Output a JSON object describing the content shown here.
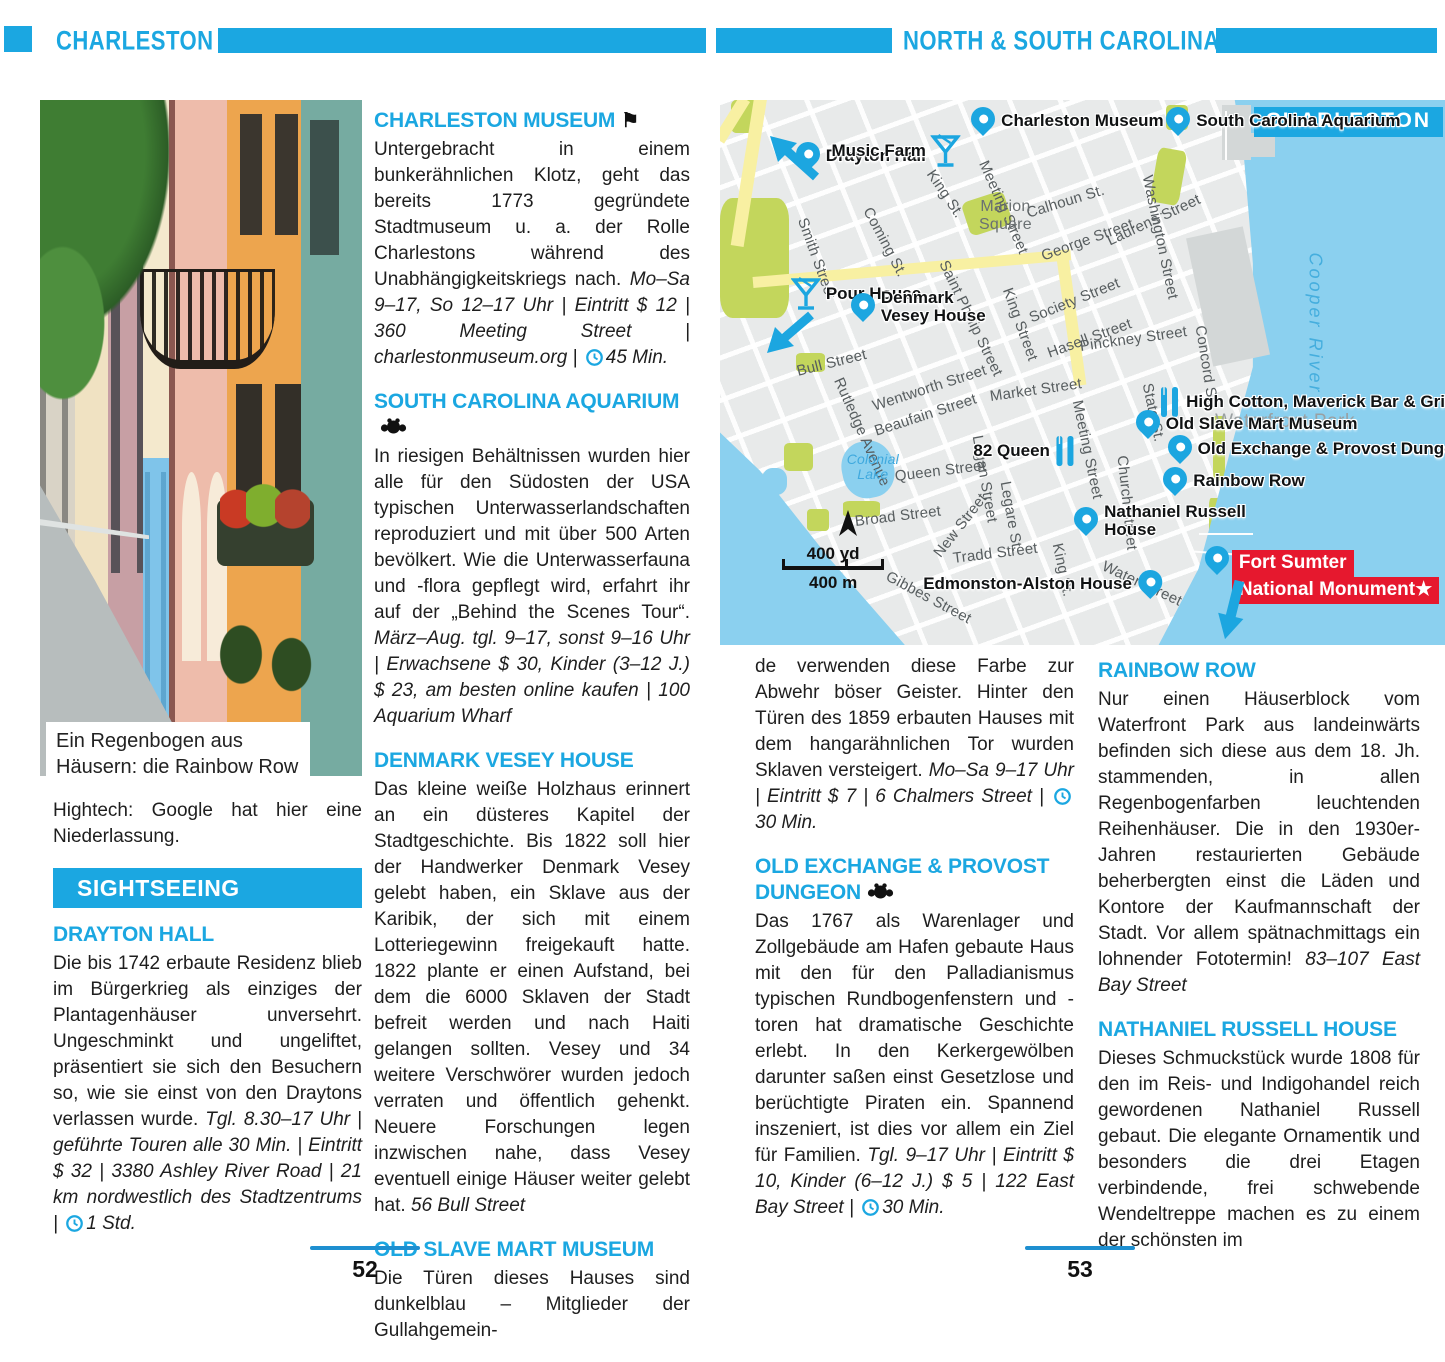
{
  "colors": {
    "accent": "#1ba7e1",
    "map_water": "#8bd0ef",
    "map_park": "#c3d65c",
    "map_road": "#f8f0a2",
    "fort_red": "#e6182e"
  },
  "header": {
    "left_title": "CHARLESTON",
    "right_title": "NORTH & SOUTH CAROLINA"
  },
  "icons": {
    "flag_glyph": "⚑",
    "star_glyph": "★"
  },
  "left_page": {
    "photo_caption": "Ein Regenbogen aus Häusern: die Rainbow Row",
    "intro_paragraph": "Hightech: Google hat hier eine Niederlassung.",
    "section_banner": "SIGHTSEEING",
    "page_number": "52"
  },
  "right_page": {
    "page_number": "53"
  },
  "articles": {
    "drayton_hall": {
      "heading": "DRAYTON HALL",
      "body": "Die bis 1742 erbaute Residenz blieb im Bürgerkrieg als einziges der Plantagenhäuser unversehrt. Ungeschminkt und ungeliftet, präsentiert sie sich den Besuchern so, wie sie einst von den Draytons verlassen wurde.",
      "info": "Tgl. 8.30–17 Uhr | geführte Touren alle 30 Min. | Eintritt $ 32 | 3380 Ashley River Road | 21 km nordwestlich des Stadtzentrums |",
      "duration": "1 Std."
    },
    "charleston_museum": {
      "heading": "CHARLESTON MUSEUM",
      "body": "Untergebracht in einem bunkerähnlichen Klotz, geht das bereits 1773 gegründete Stadtmuseum u. a. der Rolle Charlestons während des Unabhängigkeitskriegs nach.",
      "info": "Mo–Sa 9–17, So 12–17 Uhr | Eintritt $ 12 | 360 Meeting Street | charlestonmuseum.org |",
      "duration": "45 Min."
    },
    "south_carolina_aquarium": {
      "heading": "SOUTH CAROLINA AQUARIUM",
      "body": "In riesigen Behältnissen wurden hier alle für den Südosten der USA typischen Unterwasserlandschaften reproduziert und mit über 500 Arten bevölkert. Wie die Unterwasserfauna und -flora gepflegt wird, erfahrt ihr auf der „Behind the Scenes Tour“.",
      "info": "März–Aug. tgl. 9–17, sonst 9–16 Uhr | Erwachsene $ 30, Kinder (3–12 J.) $ 23, am besten online kaufen | 100 Aquarium Wharf",
      "duration": ""
    },
    "denmark_vesey_house": {
      "heading": "DENMARK VESEY HOUSE",
      "body": "Das kleine weiße Holzhaus erinnert an ein düsteres Kapitel der Stadtgeschichte. Bis 1822 soll hier der Handwerker Denmark Vesey gelebt haben, ein Sklave aus der Karibik, der sich mit einem Lotteriegewinn freigekauft hatte. 1822 plante er einen Aufstand, bei dem die 6000 Sklaven der Stadt befreit werden und nach Haiti gelangen sollten. Vesey und 34 weitere Verschwörer wurden jedoch verraten und öffentlich gehenkt. Neuere Forschungen legen inzwischen nahe, dass Vesey eventuell einige Häuser weiter gelebt hat.",
      "info": "56 Bull Street",
      "duration": ""
    },
    "old_slave_mart_museum": {
      "heading": "OLD SLAVE MART MUSEUM",
      "body": "Die Türen dieses Hauses sind dunkelblau – Mitglieder der Gullahgemein-",
      "body_continued": "de verwenden diese Farbe zur Abwehr böser Geister. Hinter den Türen des 1859 erbauten Hauses mit dem hangarähnlichen Tor wurden Sklaven versteigert.",
      "info": "Mo–Sa 9–17 Uhr | Eintritt $ 7 | 6 Chalmers Street |",
      "duration": "30 Min."
    },
    "old_exchange": {
      "heading": "OLD EXCHANGE & PROVOST DUNGEON",
      "body": "Das 1767 als Warenlager und Zollgebäude am Hafen gebaute Haus mit den für den Palladianismus typischen Rundbogenfenstern und -toren hat dramatische Geschichte erlebt. In den Kerkergewölben darunter saßen einst Gesetzlose und berüchtigte Piraten ein. Spannend inszeniert, ist dies vor allem ein Ziel für Familien.",
      "info": "Tgl. 9–17 Uhr | Eintritt $ 10, Kinder (6–12 J.) $ 5 | 122 East Bay Street |",
      "duration": "30 Min."
    },
    "rainbow_row": {
      "heading": "RAINBOW ROW",
      "body": "Nur einen Häuserblock vom Waterfront Park aus landeinwärts befinden sich diese aus dem 18. Jh. stammenden, in allen Regenbogenfarben leuchtenden Reihenhäuser. Die in den 1930er-Jahren restaurierten Gebäude beherbergten einst die Läden und Kontore der Kaufmannschaft der Stadt. Vor allem spätnachmittags ein lohnender Fototermin!",
      "info": "83–107 East Bay Street",
      "duration": ""
    },
    "nathaniel_russell_house": {
      "heading": "NATHANIEL RUSSELL HOUSE",
      "body": "Dieses Schmuckstück wurde 1808 für den im Reis- und Indigohandel reich gewordenen Nathaniel Russell gebaut. Die elegante Ornamentik und besonders die drei Etagen verbindende, frei schwebende Wendeltreppe machen es zu einem der schönsten im",
      "info": "",
      "duration": ""
    }
  },
  "map": {
    "title": "CHARLESTON",
    "fort_line1": "Fort Sumter",
    "fort_line2": "National Monument",
    "scale_yd": "400 yd",
    "scale_m": "400 m",
    "labels": [
      {
        "text": "Smith Street",
        "x": 11.3,
        "y": 20.2,
        "rot": 70,
        "cls": ""
      },
      {
        "text": "Coming St.",
        "x": 20.3,
        "y": 18.3,
        "rot": 62,
        "cls": ""
      },
      {
        "text": "King St.",
        "x": 29.0,
        "y": 11.6,
        "rot": 56,
        "cls": ""
      },
      {
        "text": "Meeting Street",
        "x": 36.3,
        "y": 9.7,
        "rot": 66,
        "cls": ""
      },
      {
        "text": "Calhoun St.",
        "x": 42.3,
        "y": 19.3,
        "rot": -17,
        "cls": ""
      },
      {
        "text": "George Street",
        "x": 44.4,
        "y": 27.2,
        "rot": -20,
        "cls": ""
      },
      {
        "text": "Society Street",
        "x": 42.8,
        "y": 38.5,
        "rot": -22,
        "cls": ""
      },
      {
        "text": "Saint Phillip Street",
        "x": 30.8,
        "y": 28.1,
        "rot": 64,
        "cls": ""
      },
      {
        "text": "King Street",
        "x": 39.6,
        "y": 33.0,
        "rot": 70,
        "cls": ""
      },
      {
        "text": "Hasell Street",
        "x": 45.2,
        "y": 45.0,
        "rot": -20,
        "cls": ""
      },
      {
        "text": "Pinckney Street",
        "x": 49.7,
        "y": 43.7,
        "rot": -8,
        "cls": ""
      },
      {
        "text": "Washington Street",
        "x": 58.9,
        "y": 12.3,
        "rot": 78,
        "cls": ""
      },
      {
        "text": "Laurens Street",
        "x": 53.5,
        "y": 24.4,
        "rot": -25,
        "cls": ""
      },
      {
        "text": "Concord St.",
        "x": 66.2,
        "y": 39.8,
        "rot": 81,
        "cls": ""
      },
      {
        "text": "Wentworth Street",
        "x": 21.1,
        "y": 54.7,
        "rot": -18,
        "cls": ""
      },
      {
        "text": "Beaufain Street",
        "x": 21.4,
        "y": 59.3,
        "rot": -18,
        "cls": ""
      },
      {
        "text": "Market Street",
        "x": 37.2,
        "y": 52.8,
        "rot": -8,
        "cls": ""
      },
      {
        "text": "Rutledge Avenue",
        "x": 16.3,
        "y": 49.5,
        "rot": 66,
        "cls": ""
      },
      {
        "text": "Queen Street",
        "x": 24.1,
        "y": 67.5,
        "rot": -7,
        "cls": ""
      },
      {
        "text": "Logan Street",
        "x": 35.4,
        "y": 60.0,
        "rot": 80,
        "cls": ""
      },
      {
        "text": "Legare St.",
        "x": 39.3,
        "y": 68.4,
        "rot": 80,
        "cls": ""
      },
      {
        "text": "Meeting Street",
        "x": 49.2,
        "y": 53.6,
        "rot": 78,
        "cls": ""
      },
      {
        "text": "Broad Street",
        "x": 18.6,
        "y": 75.8,
        "rot": -7,
        "cls": ""
      },
      {
        "text": "New Street",
        "x": 29.9,
        "y": 82.0,
        "rot": -52,
        "cls": ""
      },
      {
        "text": "Tradd Street",
        "x": 32.1,
        "y": 82.6,
        "rot": -7,
        "cls": ""
      },
      {
        "text": "King St.",
        "x": 46.5,
        "y": 79.8,
        "rot": 78,
        "cls": ""
      },
      {
        "text": "Water Street",
        "x": 52.8,
        "y": 83.9,
        "rot": 25,
        "cls": ""
      },
      {
        "text": "Gibbes Street",
        "x": 23.0,
        "y": 85.7,
        "rot": 28,
        "cls": ""
      },
      {
        "text": "Church Street",
        "x": 55.4,
        "y": 63.7,
        "rot": 84,
        "cls": ""
      },
      {
        "text": "State St.",
        "x": 58.9,
        "y": 50.5,
        "rot": 78,
        "cls": ""
      },
      {
        "text": "Bull Street",
        "x": 10.6,
        "y": 48.3,
        "rot": -14,
        "cls": ""
      },
      {
        "text": "Marion Square",
        "x": 33.3,
        "y": 18.0,
        "rot": 0,
        "cls": "lbl-square"
      },
      {
        "text": "Colonial Lake",
        "x": 16.8,
        "y": 64.5,
        "rot": 0,
        "cls": "lbl-lake"
      },
      {
        "text": "Waterfront Park",
        "x": 68.3,
        "y": 57.0,
        "rot": 0,
        "cls": "lbl-wpark"
      },
      {
        "text": "Cooper River",
        "x": 82.0,
        "y": 26.0,
        "rot": 90,
        "cls": "lbl-river"
      }
    ],
    "pois": [
      {
        "label": [
          "Drayton Hall"
        ],
        "x": 12.1,
        "y": 12.8,
        "icon": "pin",
        "side": "right"
      },
      {
        "label": [
          "Music Farm"
        ],
        "x": 31.3,
        "y": 9.2,
        "icon": "cocktail",
        "side": "left"
      },
      {
        "label": [
          "Charleston Museum"
        ],
        "x": 36.3,
        "y": 6.4,
        "icon": "pin",
        "side": "right"
      },
      {
        "label": [
          "South Carolina Aquarium"
        ],
        "x": 63.2,
        "y": 6.4,
        "icon": "pin",
        "side": "right"
      },
      {
        "label": [
          "Pour House"
        ],
        "x": 11.7,
        "y": 35.4,
        "icon": "cocktail",
        "side": "right"
      },
      {
        "label": [
          "Denmark",
          "Vesey House"
        ],
        "x": 19.7,
        "y": 40.0,
        "icon": "pin",
        "side": "right"
      },
      {
        "label": [
          "High Cotton, Maverick Bar & Grill"
        ],
        "x": 62.5,
        "y": 55.6,
        "icon": "restaurant",
        "side": "right"
      },
      {
        "label": [
          "Old Slave Mart Museum"
        ],
        "x": 59.0,
        "y": 62.0,
        "icon": "pin",
        "side": "right"
      },
      {
        "label": [
          "Old Exchange & Provost Dungeon"
        ],
        "x": 63.4,
        "y": 66.6,
        "icon": "pin",
        "side": "right"
      },
      {
        "label": [
          "Rainbow Row"
        ],
        "x": 62.8,
        "y": 72.5,
        "icon": "pin",
        "side": "right"
      },
      {
        "label": [
          "Nathaniel Russell",
          "House"
        ],
        "x": 50.5,
        "y": 79.3,
        "icon": "pin",
        "side": "right"
      },
      {
        "label": [
          "82 Queen"
        ],
        "x": 47.3,
        "y": 64.6,
        "icon": "restaurant",
        "side": "left"
      },
      {
        "label": [
          "Edmonston-Alston House"
        ],
        "x": 59.3,
        "y": 91.4,
        "icon": "pin",
        "side": "left"
      },
      {
        "label": [],
        "x": 68.6,
        "y": 87.0,
        "icon": "pin",
        "side": "right"
      }
    ]
  }
}
